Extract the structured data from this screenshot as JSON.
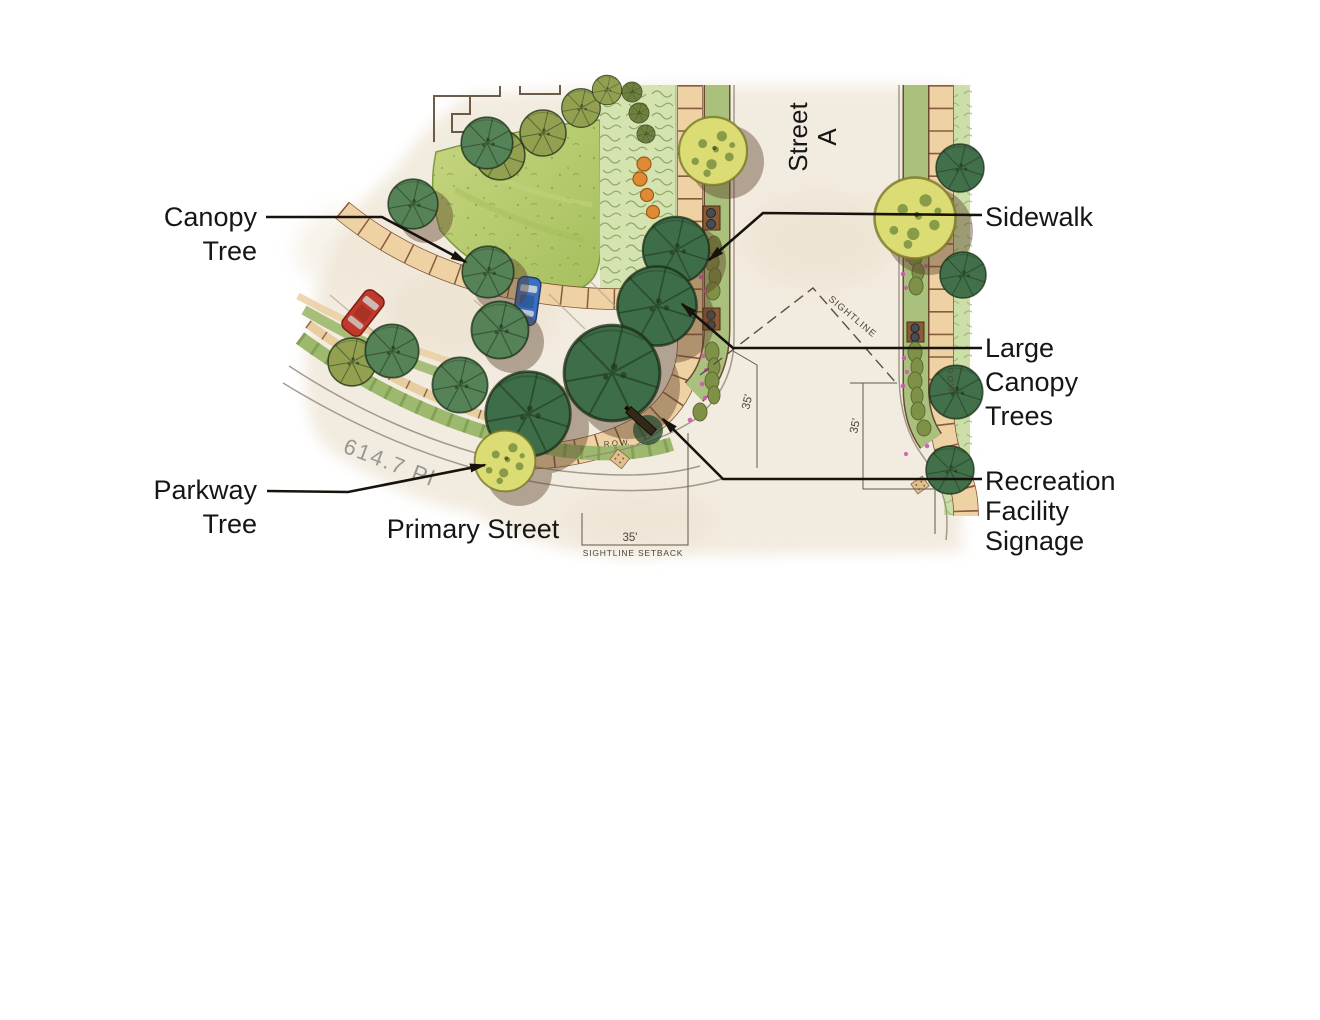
{
  "labels": {
    "canopy_tree": {
      "line1": "Canopy",
      "line2": "Tree"
    },
    "sidewalk": {
      "line1": "Sidewalk"
    },
    "large_canopy_trees": {
      "line1": "Large",
      "line2": "Canopy",
      "line3": "Trees"
    },
    "recreation_facility_signage": {
      "line1": "Recreation",
      "line2": "Facility",
      "line3": "Signage"
    },
    "parkway_tree": {
      "line1": "Parkway",
      "line2": "Tree"
    },
    "street_a": {
      "line1": "Street",
      "line2": "A"
    },
    "primary_street": "Primary Street",
    "street_curve_name": "614.7 Pl"
  },
  "annotations": {
    "sightline": "SIGHTLINE",
    "sightline_setback": "SIGHTLINE SETBACK",
    "setback_dim_left": "35'",
    "setback_dim_right": "35'",
    "setback_dim_bottom": "35'",
    "row_left": "R.O.W.",
    "row_right": "R.O.W."
  },
  "colors": {
    "background": "#ffffff",
    "label_text": "#161616",
    "leader_line": "#17120c",
    "lawn": "#b3c969",
    "paving_tan": "#eed2a4",
    "paver_joint_brown": "#7b4f33",
    "street_surface": "#f2ebdf",
    "planting_light_green": "#d4e3b0",
    "canopy_tree_dark": "#3e6e49",
    "canopy_tree_green": "#568257",
    "tree_olive": "#93a050",
    "parkway_tree_yellow": "#dcdc74",
    "tree_shadow_brown": "#5a3f28",
    "flower_pink": "#cf58b5",
    "car_red": "#c0392b",
    "car_blue": "#3b6fbe",
    "dimension_text": "#4d4536",
    "street_name_gray": "#8d8d8d"
  }
}
